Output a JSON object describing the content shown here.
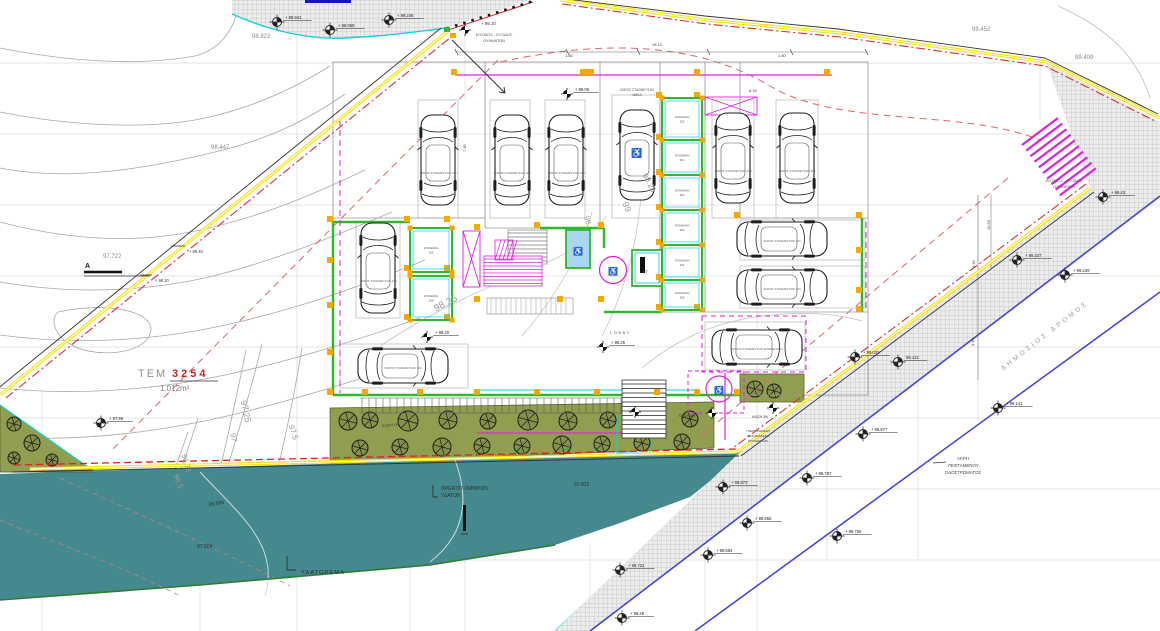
{
  "drawing": {
    "type": "architectural-site-plan",
    "colors": {
      "boundary_yellow": "#f6e316",
      "boundary_red": "#d83030",
      "setback_red": "#e06565",
      "road_blue": "#4040dd",
      "wall_green": "#2db82d",
      "detail_cyan": "#00d5e5",
      "highlight_magenta": "#dd22dd",
      "column_orange": "#f5a800",
      "water_teal": "#44898e",
      "garden_olive": "#8f9e4f",
      "contour_gray": "#a8a8a8"
    },
    "texts": [
      {
        "t": "98.822",
        "x": 252,
        "y": 38,
        "s": 6,
        "c": "#8a8a8a"
      },
      {
        "t": "98.447",
        "x": 211,
        "y": 149,
        "s": 6,
        "c": "#8a8a8a"
      },
      {
        "t": "97.722",
        "x": 103,
        "y": 258,
        "s": 6,
        "c": "#8a8a8a"
      },
      {
        "t": "99.452",
        "x": 972,
        "y": 31,
        "s": 6,
        "c": "#8a8a8a"
      },
      {
        "t": "99.409",
        "x": 1075,
        "y": 59,
        "s": 6,
        "c": "#8a8a8a"
      },
      {
        "t": "+ 99.10",
        "x": 481,
        "y": 25,
        "s": 4.4,
        "c": "#333"
      },
      {
        "t": "ΕΙΣΟΔΟΣ - ΕΞΟΔΟΣ",
        "x": 494,
        "y": 36,
        "s": 3.9,
        "c": "#555",
        "a": "middle"
      },
      {
        "t": "ΟΧΗΜΑΤΩΝ",
        "x": 494,
        "y": 42,
        "s": 3.9,
        "c": "#555",
        "a": "middle"
      },
      {
        "t": "ΕΙΣΟΔΟΣ - ΕΞΟΔΟΣ",
        "x": 1064,
        "y": 182,
        "s": 3.9,
        "c": "#555",
        "a": "middle"
      },
      {
        "t": "ΟΧΗΜΑΤΩΝ",
        "x": 1064,
        "y": 188,
        "s": 3.9,
        "c": "#555",
        "a": "middle"
      },
      {
        "t": "ΤΕΜ",
        "x": 138,
        "y": 377,
        "s": 11,
        "c": "#909090",
        "ls": 2
      },
      {
        "t": "3254",
        "x": 172,
        "y": 377,
        "s": 11,
        "c": "#d42020",
        "w": "bold",
        "ls": 3
      },
      {
        "t": "1.012m²",
        "x": 160,
        "y": 391,
        "s": 8,
        "c": "#808080"
      },
      {
        "t": "ΥΔΑΤΟΡΕΜΑ",
        "x": 301,
        "y": 574,
        "s": 5.8,
        "c": "#2a2a2a",
        "ls": 1
      },
      {
        "t": "97.812",
        "x": 574,
        "y": 486,
        "s": 5,
        "c": "#2f2f2f"
      },
      {
        "t": "97.004",
        "x": 197,
        "y": 548,
        "s": 5,
        "c": "#2f2f2f"
      },
      {
        "t": "96.998",
        "x": 209,
        "y": 506,
        "s": 5,
        "c": "#2f2f2f",
        "r": -8
      },
      {
        "t": "ΦΡΕΑΤΙΟ ΟΜΒΡΙΩΝ",
        "x": 441,
        "y": 490,
        "s": 5,
        "c": "#2f2f2f"
      },
      {
        "t": "ΥΔΑΤΩΝ",
        "x": 441,
        "y": 497,
        "s": 5,
        "c": "#2f2f2f"
      },
      {
        "t": "ΔΗΜΟΣΙΟΣ ΔΡΟΜΟΣ",
        "x": 1046,
        "y": 337,
        "s": 6.5,
        "c": "#9a9a9a",
        "r": -38,
        "a": "middle",
        "ls": 3
      },
      {
        "t": "ΑΚΡΗ",
        "x": 963,
        "y": 460,
        "s": 4.4,
        "c": "#444",
        "a": "middle"
      },
      {
        "t": "ΥΦΙΣΤΑΜΕΝΟΥ",
        "x": 963,
        "y": 467,
        "s": 4.4,
        "c": "#444",
        "a": "middle"
      },
      {
        "t": "ΟΔΟΣΤΡΩΜΑΤΟΣ",
        "x": 963,
        "y": 474,
        "s": 4.4,
        "c": "#444",
        "a": "middle"
      },
      {
        "t": "ΚΛΙΣΗ 1%",
        "x": 382,
        "y": 427,
        "s": 3.7,
        "c": "#333",
        "r": -4
      },
      {
        "t": "ΚΛΙΣΗ 5%",
        "x": 679,
        "y": 417,
        "s": 3.4,
        "c": "#333"
      },
      {
        "t": "ΚΛΙΣΗ 3%",
        "x": 752,
        "y": 418,
        "s": 3.4,
        "c": "#333"
      },
      {
        "t": "18.10",
        "x": 652,
        "y": 46,
        "s": 4,
        "c": "#444"
      },
      {
        "t": "1.80",
        "x": 565,
        "y": 57,
        "s": 4,
        "c": "#444"
      },
      {
        "t": "1.80",
        "x": 778,
        "y": 57,
        "s": 4,
        "c": "#444"
      },
      {
        "t": "6.15",
        "x": 749,
        "y": 92,
        "s": 4,
        "c": "#444"
      },
      {
        "t": "7.45",
        "x": 466,
        "y": 152,
        "s": 4,
        "c": "#444",
        "r": -90
      },
      {
        "t": "15.50",
        "x": 990,
        "y": 230,
        "s": 4,
        "c": "#444",
        "r": -90
      },
      {
        "t": "3.45",
        "x": 975,
        "y": 268,
        "s": 4,
        "c": "#444",
        "r": -90
      },
      {
        "t": "3.10",
        "x": 974,
        "y": 346,
        "s": 4,
        "c": "#444",
        "r": -90
      },
      {
        "t": "97.25",
        "x": 243,
        "y": 412,
        "s": 9,
        "c": "#9d9d9d",
        "r": 78,
        "a": "middle"
      },
      {
        "t": "97",
        "x": 231,
        "y": 438,
        "s": 8,
        "c": "#9d9d9d",
        "r": 80,
        "a": "middle"
      },
      {
        "t": "97.5",
        "x": 291,
        "y": 433,
        "s": 8,
        "c": "#9d9d9d",
        "r": 72,
        "a": "middle"
      },
      {
        "t": "96.75",
        "x": 184,
        "y": 464,
        "s": 7.5,
        "c": "#9d9d9d",
        "r": 75,
        "a": "middle"
      },
      {
        "t": "96.5",
        "x": 176,
        "y": 482,
        "s": 7.5,
        "c": "#9d9d9d",
        "r": 72,
        "a": "middle"
      },
      {
        "t": "98.25",
        "x": 447,
        "y": 306,
        "s": 10,
        "c": "#9d9d9d",
        "r": -28,
        "a": "middle"
      },
      {
        "t": "98",
        "x": 585,
        "y": 221,
        "s": 8,
        "c": "#9d9d9d",
        "r": 70,
        "a": "middle"
      },
      {
        "t": "99",
        "x": 624,
        "y": 208,
        "s": 9,
        "c": "#9d9d9d",
        "r": 68,
        "a": "middle"
      },
      {
        "t": "98.25",
        "x": 647,
        "y": 184,
        "s": 8,
        "c": "#9d9d9d",
        "r": 62,
        "a": "middle"
      },
      {
        "t": "LIFT",
        "x": 640,
        "y": 273,
        "s": 3.8,
        "c": "#333"
      },
      {
        "t": "LOBBY",
        "x": 610,
        "y": 334,
        "s": 4,
        "c": "#555",
        "ls": 1.5
      },
      {
        "t": "ΧΩΡΟΣ ΣΤΑΘΜΕΥΣΗΣ",
        "x": 637,
        "y": 91,
        "s": 3.3,
        "c": "#555",
        "a": "middle"
      },
      {
        "t": "ΑΜΕΑ",
        "x": 637,
        "y": 96,
        "s": 3.3,
        "c": "#555",
        "a": "middle"
      },
      {
        "t": "ΥΠΕΡΥΨΩΜΕΝΗ",
        "x": 758,
        "y": 432,
        "s": 3.1,
        "c": "#444",
        "a": "middle"
      },
      {
        "t": "ΠΕΖΟΔΙΑΒΑΣΗ",
        "x": 758,
        "y": 437,
        "s": 3.1,
        "c": "#444",
        "a": "middle"
      },
      {
        "t": "ΕΠΙΣΚΕΠΤΩΝ",
        "x": 758,
        "y": 442,
        "s": 3.1,
        "c": "#444",
        "a": "middle"
      },
      {
        "t": "A",
        "x": 85,
        "y": 268,
        "s": 7,
        "c": "#222",
        "w": "bold"
      },
      {
        "t": "+ 98.40",
        "x": 189,
        "y": 253,
        "s": 4.1,
        "c": "#333"
      },
      {
        "t": "+ 98.10",
        "x": 155,
        "y": 282,
        "s": 4.1,
        "c": "#333"
      }
    ],
    "benchmarks": [
      {
        "x": 277,
        "y": 22,
        "l": "+ 98.941"
      },
      {
        "x": 330,
        "y": 30,
        "l": "+ 98.958"
      },
      {
        "x": 389,
        "y": 20,
        "l": "+ 99.246"
      },
      {
        "x": 465,
        "y": 30,
        "l": "",
        "st": "solid"
      },
      {
        "x": 567,
        "y": 94,
        "l": "+ 99.05",
        "st": "solid"
      },
      {
        "x": 603,
        "y": 347,
        "l": "+ 98.25",
        "st": "solid"
      },
      {
        "x": 427,
        "y": 337,
        "l": "+ 98.20",
        "st": "solid"
      },
      {
        "x": 101,
        "y": 423,
        "l": "+ 97.96"
      },
      {
        "x": 635,
        "y": 412,
        "l": "",
        "st": "solid"
      },
      {
        "x": 712,
        "y": 413,
        "l": "",
        "st": "solid"
      },
      {
        "x": 773,
        "y": 408,
        "l": "",
        "st": "solid"
      },
      {
        "x": 1103,
        "y": 197,
        "l": "+ 99.43"
      },
      {
        "x": 1017,
        "y": 260,
        "l": "+ 99.337"
      },
      {
        "x": 1065,
        "y": 275,
        "l": "+ 99.239"
      },
      {
        "x": 998,
        "y": 408,
        "l": "+ 99.141"
      },
      {
        "x": 855,
        "y": 357,
        "l": "+ 99.031"
      },
      {
        "x": 863,
        "y": 434,
        "l": "+ 98.877"
      },
      {
        "x": 807,
        "y": 478,
        "l": "+ 98.787"
      },
      {
        "x": 747,
        "y": 523,
        "l": "+ 98.655"
      },
      {
        "x": 837,
        "y": 536,
        "l": "+ 98.758"
      },
      {
        "x": 708,
        "y": 555,
        "l": "+ 98.584"
      },
      {
        "x": 622,
        "y": 618,
        "l": "+ 98.48"
      },
      {
        "x": 620,
        "y": 570,
        "l": "+ 98.722"
      },
      {
        "x": 898,
        "y": 362,
        "l": "98.132"
      },
      {
        "x": 723,
        "y": 487,
        "l": "+ 98.673"
      }
    ],
    "cars": [
      {
        "x": 438,
        "y": 160,
        "r": 0,
        "l": "ΧΩΡΟΣ ΣΤΑΘΜΕΥΣΗΣ 102"
      },
      {
        "x": 512,
        "y": 160,
        "r": 0,
        "l": "ΧΩΡΟΣ ΣΤΑΘΜΕΥΣΗΣ 201"
      },
      {
        "x": 566,
        "y": 160,
        "r": 0,
        "l": "ΧΩΡΟΣ ΣΤΑΘΜΕΥΣΗΣ 202"
      },
      {
        "x": 637,
        "y": 155,
        "r": 0,
        "l": "",
        "amea": true
      },
      {
        "x": 733,
        "y": 158,
        "r": 0,
        "l": "ΧΩΡΟΣ ΣΤΑΘΜΕΥΣΗΣ 203"
      },
      {
        "x": 797,
        "y": 158,
        "r": 0,
        "l": "ΧΩΡΟΣ ΣΤΑΘΜΕΥΣΗΣ 301"
      },
      {
        "x": 378,
        "y": 268,
        "r": 0,
        "l": "ΧΩΡΟΣ ΣΤΑΘΜΕΥΣΗΣ 103"
      },
      {
        "x": 403,
        "y": 366,
        "r": 90,
        "l": "ΧΩΡΟΣ ΣΤΑΘΜΕΥΣΗΣ 101"
      },
      {
        "x": 782,
        "y": 239,
        "r": 90,
        "l": "ΧΩΡΟΣ ΣΤΑΘΜΕΥΣΗΣ 302"
      },
      {
        "x": 782,
        "y": 287,
        "r": 90,
        "l": "ΧΩΡΟΣ ΣΤΑΘΜΕΥΣΗΣ 303"
      },
      {
        "x": 757,
        "y": 347,
        "r": 90,
        "l": "ΧΩΡΟΣ ΣΤΑΘΜΕΥΣΗΣ ΕΠΙΣΚΕΠΤΩΝ"
      }
    ],
    "rooms": [
      {
        "x": 410,
        "y": 228,
        "w": 42,
        "h": 44,
        "name": "ΑΠΟΘΗΚΗ",
        "num": "103"
      },
      {
        "x": 410,
        "y": 276,
        "w": 42,
        "h": 44,
        "name": "ΑΠΟΘΗΚΗ",
        "num": "104"
      },
      {
        "x": 662,
        "y": 98,
        "w": 40,
        "h": 42,
        "name": "ΑΠΟΘΗΚΗ",
        "num": "202"
      },
      {
        "x": 662,
        "y": 140,
        "w": 40,
        "h": 35,
        "name": "ΑΠΟΘΗΚΗ",
        "num": "301"
      },
      {
        "x": 662,
        "y": 175,
        "w": 40,
        "h": 35,
        "name": "ΑΠΟΘΗΚΗ",
        "num": "302"
      },
      {
        "x": 662,
        "y": 210,
        "w": 40,
        "h": 35,
        "name": "ΑΠΟΘΗΚΗ",
        "num": "303"
      },
      {
        "x": 662,
        "y": 245,
        "w": 40,
        "h": 35,
        "name": "ΑΠΟΘΗΚΗ",
        "num": "304"
      },
      {
        "x": 662,
        "y": 280,
        "w": 40,
        "h": 30,
        "name": "ΑΠΟΘΗΚΗ",
        "num": "305"
      }
    ],
    "trees": [
      {
        "x": 348,
        "y": 421,
        "r": 9
      },
      {
        "x": 370,
        "y": 420,
        "r": 8
      },
      {
        "x": 408,
        "y": 421,
        "r": 10
      },
      {
        "x": 448,
        "y": 420,
        "r": 9
      },
      {
        "x": 488,
        "y": 421,
        "r": 8
      },
      {
        "x": 528,
        "y": 420,
        "r": 10
      },
      {
        "x": 568,
        "y": 421,
        "r": 9
      },
      {
        "x": 608,
        "y": 420,
        "r": 8
      },
      {
        "x": 648,
        "y": 420,
        "r": 9
      },
      {
        "x": 690,
        "y": 419,
        "r": 8
      },
      {
        "x": 360,
        "y": 448,
        "r": 8
      },
      {
        "x": 400,
        "y": 447,
        "r": 8
      },
      {
        "x": 442,
        "y": 447,
        "r": 9
      },
      {
        "x": 482,
        "y": 446,
        "r": 8
      },
      {
        "x": 522,
        "y": 446,
        "r": 8
      },
      {
        "x": 562,
        "y": 445,
        "r": 9
      },
      {
        "x": 602,
        "y": 444,
        "r": 8
      },
      {
        "x": 642,
        "y": 443,
        "r": 8
      },
      {
        "x": 682,
        "y": 442,
        "r": 8
      },
      {
        "x": 14,
        "y": 424,
        "r": 7
      },
      {
        "x": 32,
        "y": 443,
        "r": 8
      },
      {
        "x": 14,
        "y": 458,
        "r": 6
      },
      {
        "x": 52,
        "y": 460,
        "r": 6
      },
      {
        "x": 755,
        "y": 389,
        "r": 8
      },
      {
        "x": 774,
        "y": 391,
        "r": 7
      }
    ]
  }
}
